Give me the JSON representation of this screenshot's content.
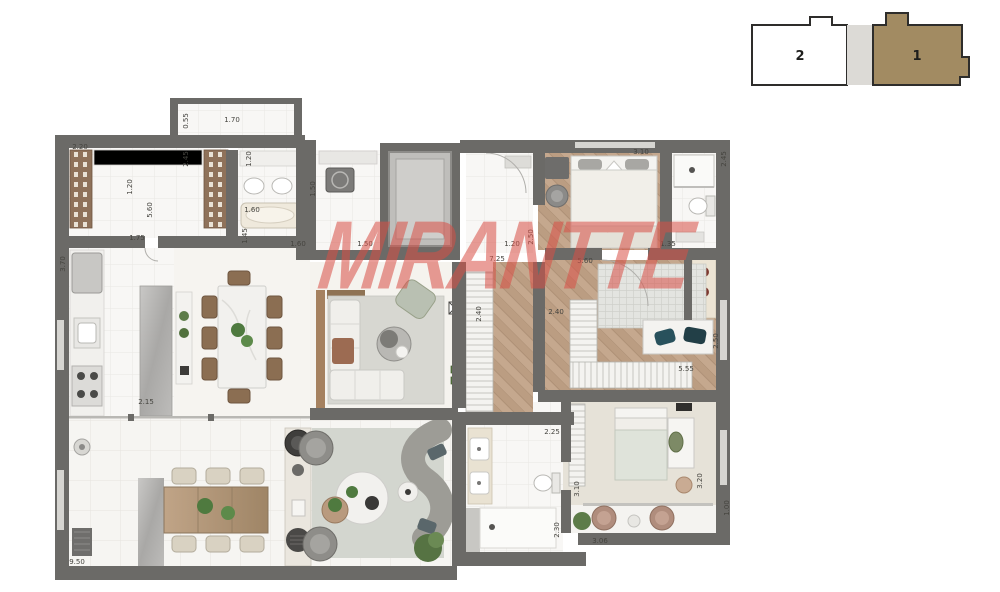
{
  "watermark": {
    "text": "MIRANTTE",
    "color": "#d94f46"
  },
  "keyplan": {
    "unit2": "2",
    "unit1": "1",
    "highlight_hex": "#a28b62",
    "core_hex": "#dcdad6"
  },
  "palette": {
    "wall": "#6b6a67",
    "wood": "#c5a88e",
    "tile": "#f8f7f5",
    "watermark_red": "#d94f46"
  },
  "dimensions": [
    {
      "t": "2.20",
      "x": 80,
      "y": 147,
      "r": 0
    },
    {
      "t": "1.70",
      "x": 232,
      "y": 120,
      "r": 0
    },
    {
      "t": "0.55",
      "x": 186,
      "y": 121,
      "r": -90
    },
    {
      "t": "1.20",
      "x": 130,
      "y": 187,
      "r": -90
    },
    {
      "t": "5.60",
      "x": 150,
      "y": 210,
      "r": -90
    },
    {
      "t": "2.45",
      "x": 186,
      "y": 159,
      "r": -90
    },
    {
      "t": "1.20",
      "x": 249,
      "y": 159,
      "r": -90
    },
    {
      "t": "1.75",
      "x": 137,
      "y": 238,
      "r": 0
    },
    {
      "t": "1.60",
      "x": 252,
      "y": 210,
      "r": 0
    },
    {
      "t": "1.45",
      "x": 245,
      "y": 236,
      "r": -90
    },
    {
      "t": "1.60",
      "x": 298,
      "y": 244,
      "r": 0
    },
    {
      "t": "1.50",
      "x": 365,
      "y": 244,
      "r": 0
    },
    {
      "t": "1.50",
      "x": 313,
      "y": 189,
      "r": -90
    },
    {
      "t": "7.25",
      "x": 497,
      "y": 259,
      "r": 0
    },
    {
      "t": "1.20",
      "x": 512,
      "y": 244,
      "r": 0
    },
    {
      "t": "2.50",
      "x": 531,
      "y": 237,
      "r": -90
    },
    {
      "t": "5.60",
      "x": 585,
      "y": 261,
      "r": 0
    },
    {
      "t": "3.10",
      "x": 641,
      "y": 152,
      "r": 0
    },
    {
      "t": "2.45",
      "x": 724,
      "y": 159,
      "r": -90
    },
    {
      "t": "1.35",
      "x": 668,
      "y": 244,
      "r": 0
    },
    {
      "t": "2.40",
      "x": 479,
      "y": 314,
      "r": -90
    },
    {
      "t": "2.40",
      "x": 556,
      "y": 312,
      "r": 0
    },
    {
      "t": "5.55",
      "x": 686,
      "y": 369,
      "r": 0
    },
    {
      "t": "2.50",
      "x": 716,
      "y": 341,
      "r": -90
    },
    {
      "t": "2.25",
      "x": 552,
      "y": 432,
      "r": 0
    },
    {
      "t": "3.10",
      "x": 577,
      "y": 489,
      "r": -90
    },
    {
      "t": "2.30",
      "x": 557,
      "y": 530,
      "r": -90
    },
    {
      "t": "3.20",
      "x": 700,
      "y": 481,
      "r": -90
    },
    {
      "t": "1.00",
      "x": 727,
      "y": 508,
      "r": -90
    },
    {
      "t": "3.06",
      "x": 600,
      "y": 541,
      "r": 0
    },
    {
      "t": "9.50",
      "x": 77,
      "y": 562,
      "r": 0
    },
    {
      "t": "2.15",
      "x": 146,
      "y": 402,
      "r": 0
    },
    {
      "t": "3.70",
      "x": 63,
      "y": 264,
      "r": -90
    }
  ]
}
